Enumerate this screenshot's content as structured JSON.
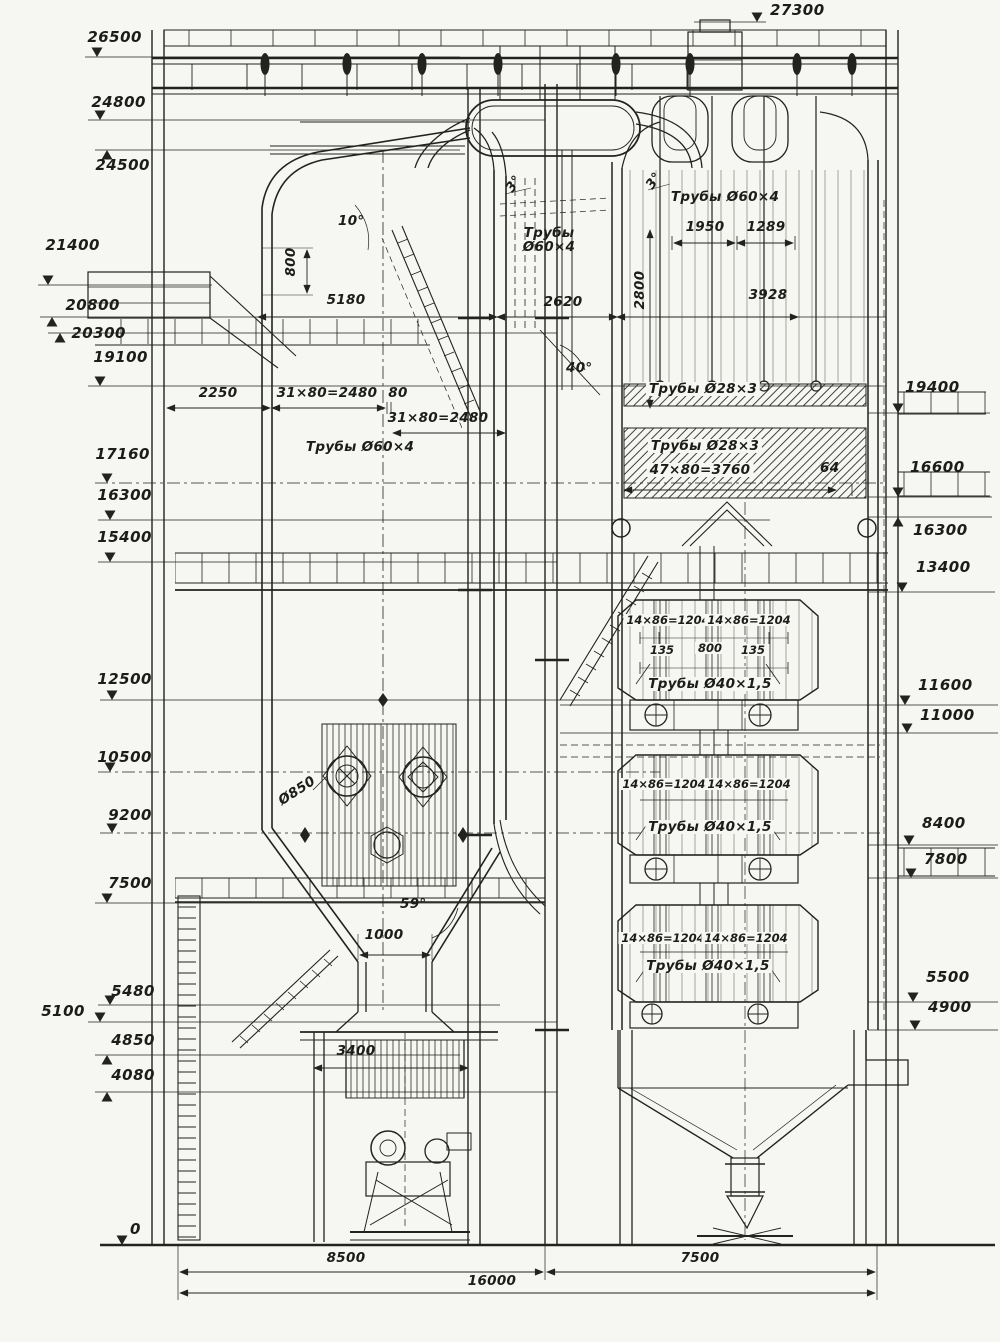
{
  "drawing": {
    "elevations_left": [
      "26500",
      "24800",
      "24500",
      "21400",
      "20800",
      "20300",
      "19100",
      "17160",
      "16300",
      "15400",
      "12500",
      "10500",
      "9200",
      "7500",
      "5480",
      "5100",
      "4850",
      "4080",
      "0"
    ],
    "elevations_right": [
      "27300",
      "19400",
      "16600",
      "16300",
      "13400",
      "11600",
      "11000",
      "8400",
      "7800",
      "5500",
      "4900"
    ],
    "angles": {
      "roof": "10°",
      "slope_left": "3°",
      "slope_right": "3°",
      "baffle": "40°",
      "funnel": "59°"
    },
    "tubes": {
      "platen": "Трубы\nØ60×4",
      "superheater": "Трубы Ø60×4",
      "furnace": "Трубы Ø60×4",
      "bank1": "Трубы Ø28×3",
      "bank2": "Трубы Ø28×3"
    },
    "dims": {
      "roof_rise": "800",
      "furnace_width": "5180",
      "gap": "2620",
      "sh_height": "2800",
      "sh_span1": "1950",
      "sh_span2": "1289",
      "shaft_width": "3928",
      "front": "2250",
      "pitch_a": "31×80=2480",
      "pitch_gap": "80",
      "pitch_b": "31×80=2480",
      "pitch_mid": "47×80=3760",
      "mid_gap": "64",
      "throat": "1000",
      "slag_width": "3400",
      "burner": "Ø850",
      "span_left": "8500",
      "span_right": "7500",
      "span_total": "16000"
    },
    "econ_blocks": [
      {
        "pitch1": "14×86=1204",
        "pitch2": "14×86=1204",
        "seg1": "135",
        "seg2": "800",
        "seg3": "135",
        "tube": "Трубы Ø40×1,5"
      },
      {
        "pitch1": "14×86=1204",
        "pitch2": "14×86=1204",
        "tube": "Трубы Ø40×1,5"
      },
      {
        "pitch1": "14×86=1204",
        "pitch2": "14×86=1204",
        "tube": "Трубы Ø40×1,5"
      }
    ]
  }
}
